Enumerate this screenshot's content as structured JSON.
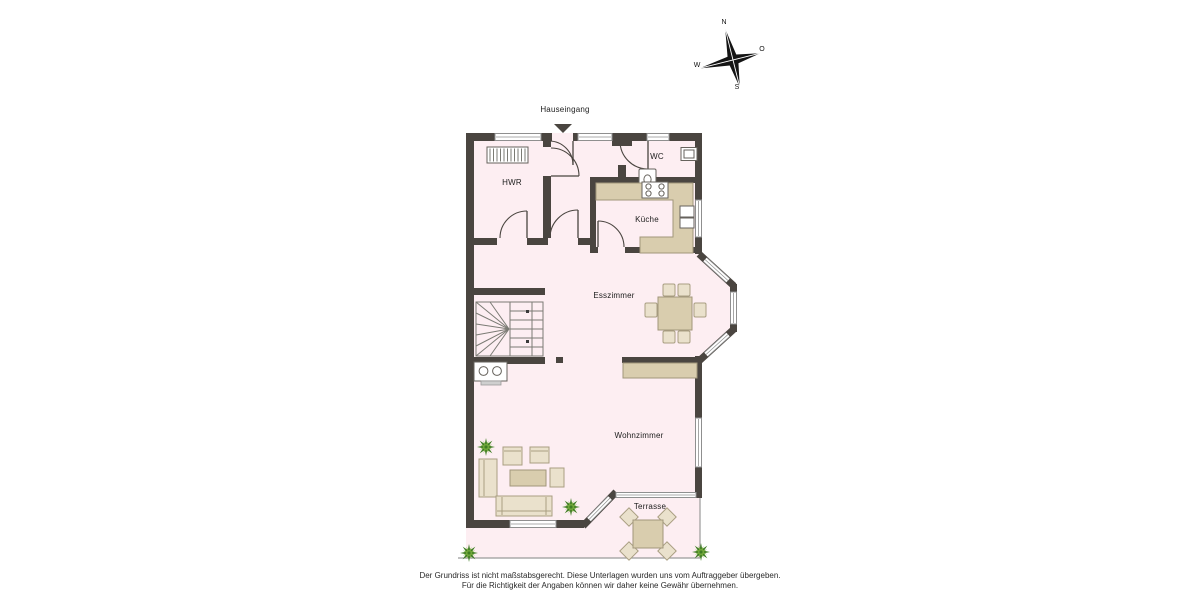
{
  "compass": {
    "north": "N",
    "east": "O",
    "south": "S",
    "west": "W"
  },
  "labels": {
    "entrance": "Hauseingang",
    "utility": "HWR",
    "wc": "WC",
    "kitchen": "Küche",
    "dining": "Esszimmer",
    "living": "Wohnzimmer",
    "terrace": "Terrasse"
  },
  "disclaimer": {
    "line1": "Der Grundriss ist nicht maßstabsgerecht. Diese Unterlagen wurden uns vom Auftraggeber übergeben.",
    "line2": "Für die Richtigkeit der Angaben können wir daher keine Gewähr übernehmen."
  },
  "symbols": {
    "compass": "compass-rose-icon",
    "entrance_marker": "entrance-arrow-icon",
    "stairs": "winder-stairs-icon",
    "radiator": "radiator-icon",
    "stove": "stove-icon",
    "sink": "kitchen-sink-icon",
    "toilet": "toilet-icon",
    "washbasin": "washbasin-icon",
    "plants": "plant-icon"
  },
  "colors": {
    "wall": "#4a4540",
    "floor": "#fdeef2",
    "furniture": "#d9cdae",
    "furniture_light": "#eae1cc",
    "frame": "#8f8f8f",
    "plant_dark": "#3e7d22",
    "plant_light": "#79ae3e",
    "text": "#1d1d1d"
  }
}
